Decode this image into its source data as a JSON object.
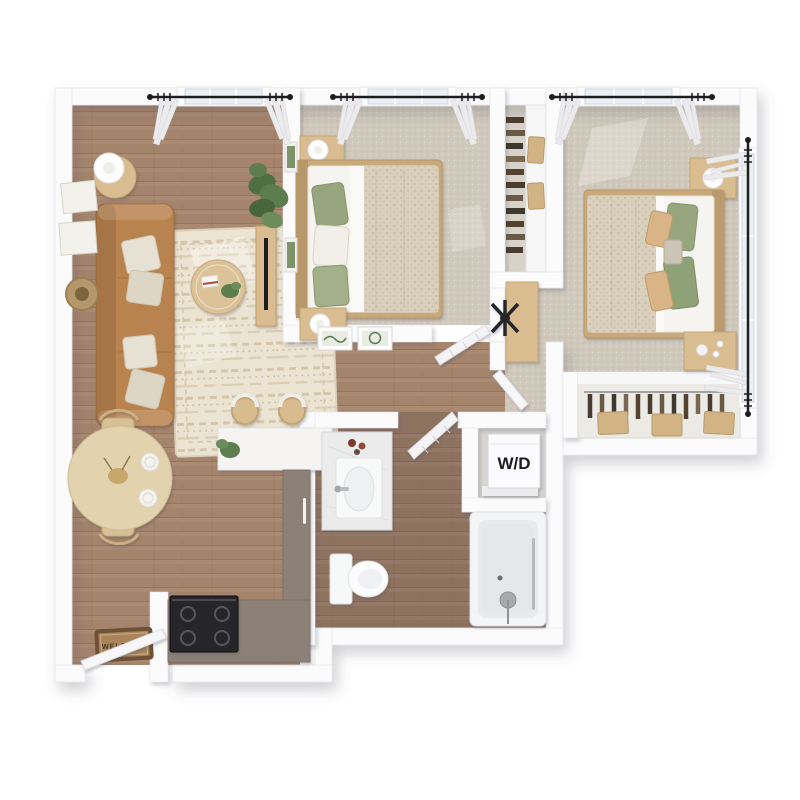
{
  "scene": {
    "alt": "3D rendered top-down floor plan of a two-bedroom, one-bathroom apartment with open living, dining and kitchen area, hallway bathroom, stacked washer/dryer nook labeled W/D, two carpeted bedrooms with closets, and a WELCOME mat at the entry door.",
    "labels": {
      "washer_dryer": "W/D",
      "welcome_mat": "WELCOME"
    },
    "rooms": [
      "living-room",
      "dining-area",
      "kitchen",
      "entry",
      "hallway",
      "bathroom",
      "laundry-nook",
      "bedroom-1",
      "bedroom-2",
      "walk-in-closet",
      "bedroom-2-closet"
    ],
    "furniture": [
      "sofa",
      "throw-pillows",
      "area-rug",
      "coffee-table",
      "floor-lamps",
      "side-tables",
      "potted-plants",
      "tv-console",
      "round-dining-table",
      "dining-chairs",
      "wall-art",
      "round-wall-mirror",
      "kitchen-peninsula",
      "bar-stools",
      "range",
      "welcome-mat",
      "bed",
      "nightstands",
      "table-lamps",
      "desk",
      "desk-chair",
      "vanity-sink",
      "toilet",
      "bathtub",
      "stacked-washer-dryer",
      "hanging-clothes",
      "storage-boxes",
      "curtains",
      "windows"
    ],
    "palette": {
      "background": "#ffffff",
      "wall": "#fbfbfc",
      "wood_floor": "#a5846c",
      "wood_floor_dark": "#8e7260",
      "carpet": "#d0c9bb",
      "rug": "#ece4d3",
      "sofa": "#b9834f",
      "wood_furniture": "#d9bd90",
      "cabinet": "#8b8177",
      "counter": "#f5f4f2",
      "range": "#28282b",
      "appliance": "#fbfbfd",
      "mat": "#a9845a",
      "plant": "#5d7d4e",
      "pillow_green": "#97a67e",
      "pillow_tan": "#d8b486",
      "bedding": "#d9cfbd",
      "curtain": "#ebebee",
      "rod": "#1d1d1f",
      "window_glass": "#e9eff2",
      "tub": "#e8eaeb",
      "label_text": "#1a1a1a"
    }
  }
}
